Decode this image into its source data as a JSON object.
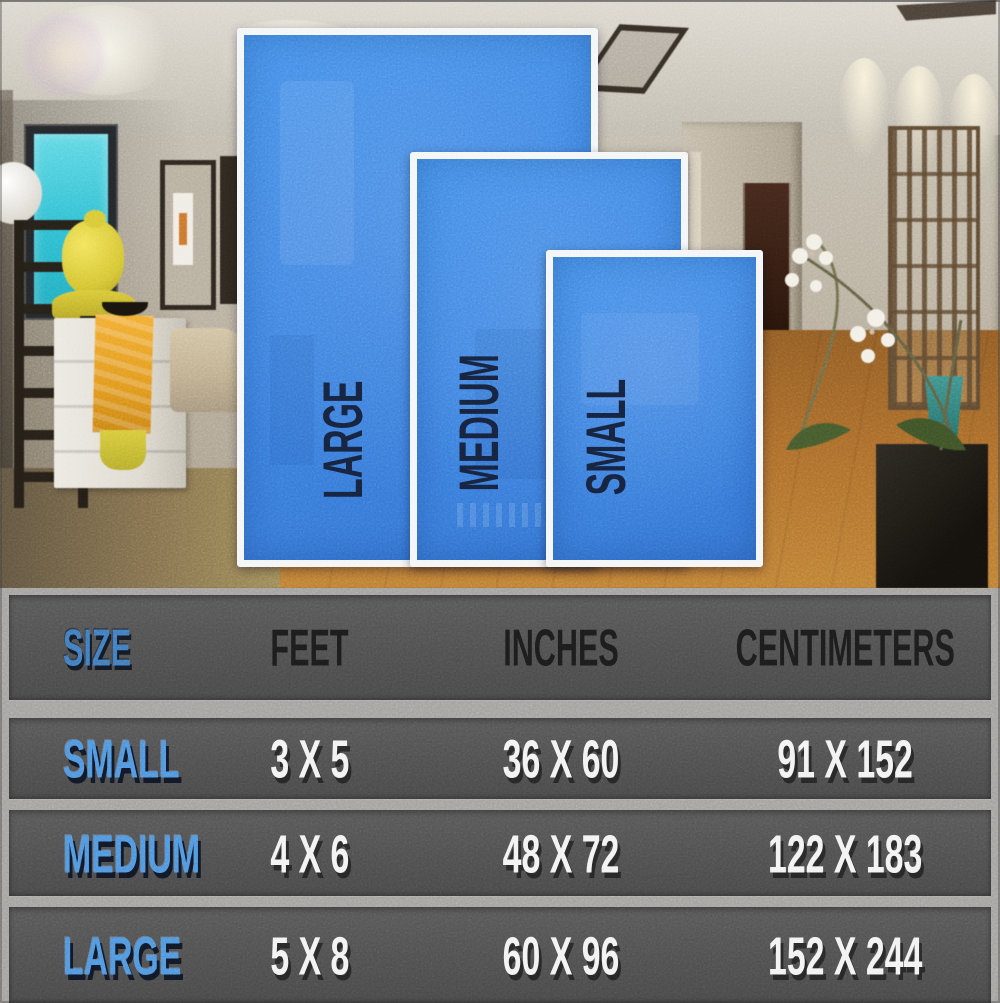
{
  "scene": {
    "rugs": [
      {
        "id": "large",
        "label": "LARGE"
      },
      {
        "id": "medium",
        "label": "MEDIUM"
      },
      {
        "id": "small",
        "label": "SMALL"
      }
    ]
  },
  "table": {
    "columns": [
      "SIZE",
      "FEET",
      "INCHES",
      "CENTIMETERS"
    ],
    "rows": [
      {
        "size": "SMALL",
        "feet": "3 X 5",
        "inches": "36 X 60",
        "centimeters": "91 X 152"
      },
      {
        "size": "MEDIUM",
        "feet": "4 X 6",
        "inches": "48 X 72",
        "centimeters": "122 X 183"
      },
      {
        "size": "LARGE",
        "feet": "5 X 8",
        "inches": "60 X 96",
        "centimeters": "152 X 244"
      }
    ]
  },
  "colors": {
    "rug_blue": "#3c7ee1",
    "rug_label_navy": "#15223c",
    "table_band_gray": "#4e4e4e",
    "separator_gray": "#a2a09d",
    "table_label_blue": "#4e92de",
    "value_white": "#f2f2f2"
  }
}
